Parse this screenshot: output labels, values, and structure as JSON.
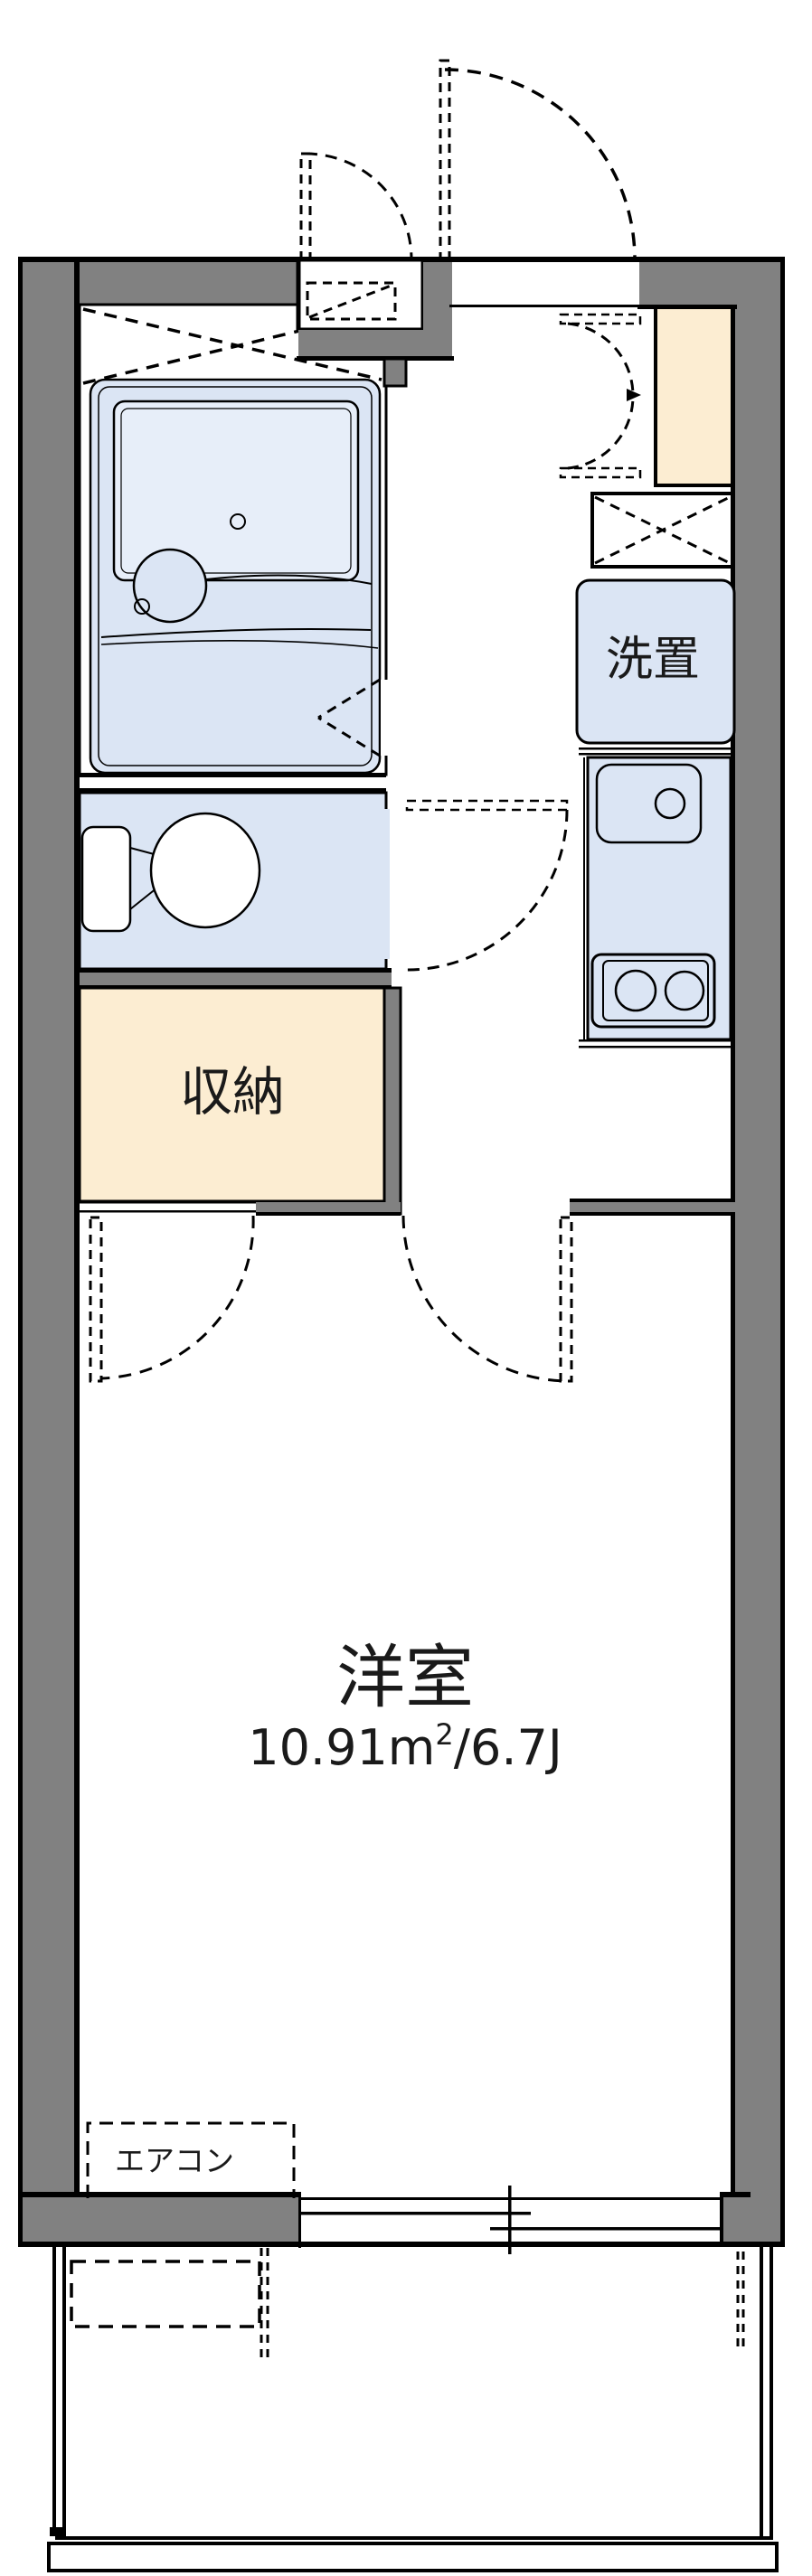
{
  "plan": {
    "kind": "japanese-apartment-floor-plan",
    "labels": {
      "washer": "洗置",
      "closet": "収納",
      "main_room": "洋室",
      "main_room_size_full": "10.91㎡/6.7J",
      "size_value": "10.91m",
      "size_sup": "2",
      "size_unit_j": "/6.7J",
      "aircon": "エアコン"
    },
    "colors": {
      "wall": "#818181",
      "water_area": "#dbe5f4",
      "tub": "#e7eef9",
      "storage": "#fcedd2",
      "line": "#000000",
      "background": "#ffffff"
    }
  }
}
